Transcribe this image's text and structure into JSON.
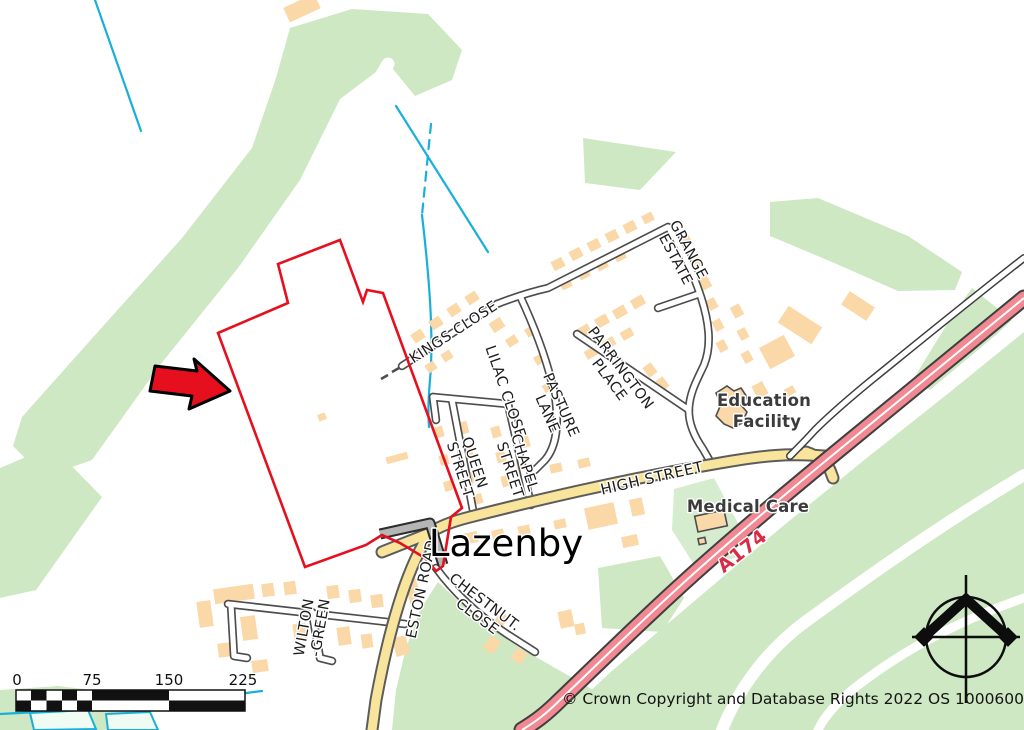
{
  "map": {
    "title_label": "Lazenby",
    "streets": {
      "kings_close": "KINGS CLOSE",
      "grange_estate": [
        "GRANGE",
        "ESTATE"
      ],
      "parrington_place": [
        "PARRINGTON",
        "PLACE"
      ],
      "pasture_lane": [
        "PASTURE",
        "LANE"
      ],
      "lilac_close": "LILAC CLOSE-",
      "chapel_street": [
        "CHAPEL",
        "STREET"
      ],
      "queen_street": [
        "QUEEN",
        "STREET"
      ],
      "high_street": "HIGH STREET",
      "eston_road": "ESTON ROAD",
      "chestnut_close": [
        "CHESTNUT.",
        "CLOSE"
      ],
      "wilton_green": [
        "WILTON",
        "-GREEN"
      ]
    },
    "pois": {
      "education_facility": [
        "Education",
        "Facility"
      ],
      "medical_care": "Medical Care"
    },
    "road_ref": "A174",
    "scale_bar": {
      "ticks": [
        "0",
        "75",
        "150",
        "225"
      ]
    },
    "copyright": "© Crown Copyright and Database Rights 2022 OS 100060020",
    "colors": {
      "green": "#cde8c2",
      "green-site": "#d5ecce",
      "building": "#fad8a7",
      "building-stroke": "#4d4d4d",
      "road-casing": "#4d4d4d",
      "yellow-fill": "#f8e49b",
      "yellow-casing": "#5c5c5c",
      "aroad-fill": "#f28892",
      "aroad-casing": "#3f3f3f",
      "gray-fill": "#b5b5b5",
      "water": "#18b0d8",
      "boundary": "#e60f1e",
      "label": "#1c1c1c",
      "aref": "#d92b45"
    }
  }
}
